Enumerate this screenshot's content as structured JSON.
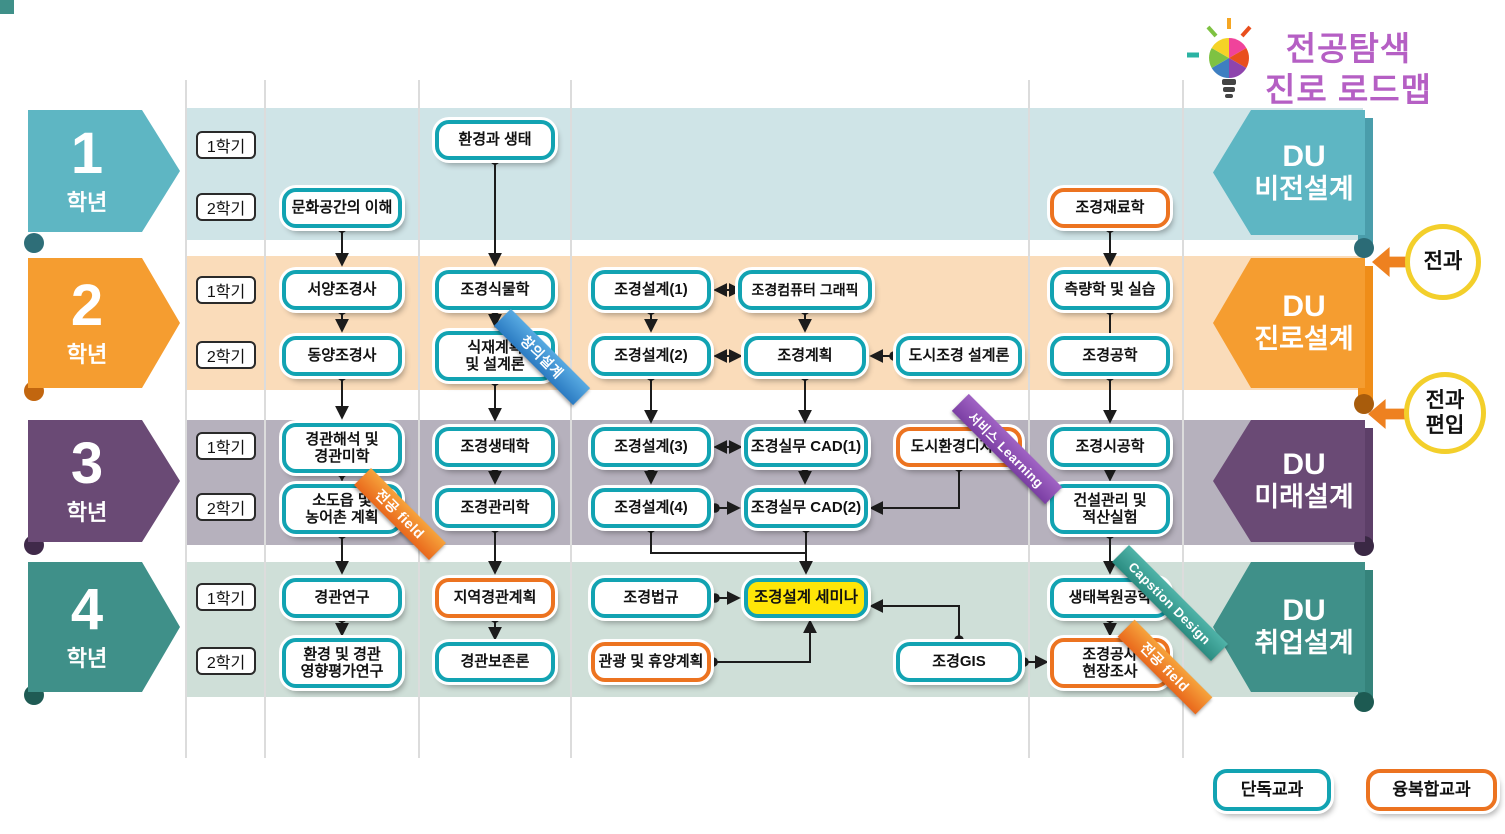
{
  "title": {
    "line1": "전공탐색",
    "line2": "진로 로드맵"
  },
  "years": [
    {
      "num": "1",
      "label": "학년",
      "sem1": "1학기",
      "sem2": "2학기",
      "du_line1": "DU",
      "du_line2": "비전설계",
      "color": "#5eb6c3",
      "band_color": "#cfe4e7"
    },
    {
      "num": "2",
      "label": "학년",
      "sem1": "1학기",
      "sem2": "2학기",
      "du_line1": "DU",
      "du_line2": "진로설계",
      "color": "#f59d30",
      "band_color": "#fadcba"
    },
    {
      "num": "3",
      "label": "학년",
      "sem1": "1학기",
      "sem2": "2학기",
      "du_line1": "DU",
      "du_line2": "미래설계",
      "color": "#6a4a75",
      "band_color": "#b6b1bd"
    },
    {
      "num": "4",
      "label": "학년",
      "sem1": "1학기",
      "sem2": "2학기",
      "du_line1": "DU",
      "du_line2": "취업설계",
      "color": "#3f9089",
      "band_color": "#cfdfd8"
    }
  ],
  "callouts": [
    {
      "label": "전과"
    },
    {
      "label": "전과\n편입"
    }
  ],
  "legend": [
    {
      "label": "단독교과",
      "border_color": "#12a3b2"
    },
    {
      "label": "융복합교과",
      "border_color": "#ec7320"
    }
  ],
  "ribbons": [
    {
      "label": "창의설계",
      "color": "#2b7bc2",
      "attached_to": "식재계획 및 설계론"
    },
    {
      "label": "전공 field",
      "color": "#e9681c",
      "attached_to": "소도읍 및 농어촌 계획"
    },
    {
      "label": "서비스 Learning",
      "color": "#7b3fa3",
      "attached_to": "도시환경디자인"
    },
    {
      "label": "Capstion Design",
      "color": "#2b8c81",
      "attached_to": "생태복원공학"
    },
    {
      "label": "전공 field",
      "color": "#e9681c",
      "attached_to": "조경공사 현장조사"
    }
  ],
  "courses": [
    {
      "label": "환경과 생태",
      "type": "단독교과",
      "year": 1,
      "semester": "1학기"
    },
    {
      "label": "문화공간의 이해",
      "type": "단독교과",
      "year": 1,
      "semester": "2학기"
    },
    {
      "label": "조경재료학",
      "type": "융복합교과",
      "year": 1,
      "semester": "2학기"
    },
    {
      "label": "서양조경사",
      "type": "단독교과",
      "year": 2,
      "semester": "1학기"
    },
    {
      "label": "조경식물학",
      "type": "단독교과",
      "year": 2,
      "semester": "1학기"
    },
    {
      "label": "조경설계(1)",
      "type": "단독교과",
      "year": 2,
      "semester": "1학기"
    },
    {
      "label": "조경컴퓨터 그래픽",
      "type": "단독교과",
      "year": 2,
      "semester": "1학기"
    },
    {
      "label": "측량학 및 실습",
      "type": "단독교과",
      "year": 2,
      "semester": "1학기"
    },
    {
      "label": "동양조경사",
      "type": "단독교과",
      "year": 2,
      "semester": "2학기"
    },
    {
      "label": "식재계획\n및 설계론",
      "type": "단독교과",
      "year": 2,
      "semester": "2학기"
    },
    {
      "label": "조경설계(2)",
      "type": "단독교과",
      "year": 2,
      "semester": "2학기"
    },
    {
      "label": "조경계획",
      "type": "단독교과",
      "year": 2,
      "semester": "2학기"
    },
    {
      "label": "도시조경 설계론",
      "type": "단독교과",
      "year": 2,
      "semester": "2학기"
    },
    {
      "label": "조경공학",
      "type": "단독교과",
      "year": 2,
      "semester": "2학기"
    },
    {
      "label": "경관해석 및\n경관미학",
      "type": "단독교과",
      "year": 3,
      "semester": "1학기"
    },
    {
      "label": "조경생태학",
      "type": "단독교과",
      "year": 3,
      "semester": "1학기"
    },
    {
      "label": "조경설계(3)",
      "type": "단독교과",
      "year": 3,
      "semester": "1학기"
    },
    {
      "label": "조경실무 CAD(1)",
      "type": "단독교과",
      "year": 3,
      "semester": "1학기"
    },
    {
      "label": "도시환경디자인",
      "type": "융복합교과",
      "year": 3,
      "semester": "1학기"
    },
    {
      "label": "조경시공학",
      "type": "단독교과",
      "year": 3,
      "semester": "1학기"
    },
    {
      "label": "소도읍 및\n농어촌 계획",
      "type": "단독교과",
      "year": 3,
      "semester": "2학기"
    },
    {
      "label": "조경관리학",
      "type": "단독교과",
      "year": 3,
      "semester": "2학기"
    },
    {
      "label": "조경설계(4)",
      "type": "단독교과",
      "year": 3,
      "semester": "2학기"
    },
    {
      "label": "조경실무 CAD(2)",
      "type": "단독교과",
      "year": 3,
      "semester": "2학기"
    },
    {
      "label": "건설관리 및\n적산실험",
      "type": "단독교과",
      "year": 3,
      "semester": "2학기"
    },
    {
      "label": "경관연구",
      "type": "단독교과",
      "year": 4,
      "semester": "1학기"
    },
    {
      "label": "지역경관계획",
      "type": "융복합교과",
      "year": 4,
      "semester": "1학기"
    },
    {
      "label": "조경법규",
      "type": "단독교과",
      "year": 4,
      "semester": "1학기"
    },
    {
      "label": "조경설계 세미나",
      "type": "단독교과",
      "highlight": "yellow",
      "year": 4,
      "semester": "1학기"
    },
    {
      "label": "생태복원공학",
      "type": "단독교과",
      "year": 4,
      "semester": "1학기"
    },
    {
      "label": "환경 및 경관\n영향평가연구",
      "type": "단독교과",
      "year": 4,
      "semester": "2학기"
    },
    {
      "label": "경관보존론",
      "type": "단독교과",
      "year": 4,
      "semester": "2학기"
    },
    {
      "label": "관광 및 휴양계획",
      "type": "융복합교과",
      "year": 4,
      "semester": "2학기"
    },
    {
      "label": "조경GIS",
      "type": "단독교과",
      "year": 4,
      "semester": "2학기"
    },
    {
      "label": "조경공사\n현장조사",
      "type": "융복합교과",
      "year": 4,
      "semester": "2학기"
    }
  ],
  "connections": [
    {
      "from": "환경과 생태",
      "to": "조경식물학",
      "style": "arrow"
    },
    {
      "from": "문화공간의 이해",
      "to": "서양조경사",
      "style": "arrow"
    },
    {
      "from": "조경재료학",
      "to": "측량학 및 실습",
      "style": "arrow"
    },
    {
      "from": "서양조경사",
      "to": "동양조경사",
      "style": "arrow"
    },
    {
      "from": "조경식물학",
      "to": "식재계획 및 설계론",
      "style": "arrow"
    },
    {
      "from": "조경설계(1)",
      "to": "조경설계(2)",
      "style": "arrow"
    },
    {
      "from": "조경컴퓨터 그래픽",
      "to": "조경계획",
      "style": "arrow"
    },
    {
      "from": "조경설계(1)",
      "to": "조경컴퓨터 그래픽",
      "style": "double"
    },
    {
      "from": "조경설계(2)",
      "to": "조경계획",
      "style": "double"
    },
    {
      "from": "도시조경 설계론",
      "to": "조경계획",
      "style": "arrow"
    },
    {
      "from": "측량학 및 실습",
      "to": "조경공학",
      "style": "line"
    },
    {
      "from": "동양조경사",
      "to": "경관해석 및 경관미학",
      "style": "arrow"
    },
    {
      "from": "식재계획 및 설계론",
      "to": "조경생태학",
      "style": "arrow"
    },
    {
      "from": "조경설계(2)",
      "to": "조경설계(3)",
      "style": "arrow"
    },
    {
      "from": "조경계획",
      "to": "조경실무 CAD(1)",
      "style": "arrow"
    },
    {
      "from": "조경공학",
      "to": "조경시공학",
      "style": "arrow"
    },
    {
      "from": "조경설계(3)",
      "to": "조경실무 CAD(1)",
      "style": "double"
    },
    {
      "from": "경관해석 및 경관미학",
      "to": "소도읍 및 농어촌 계획",
      "style": "arrow"
    },
    {
      "from": "조경생태학",
      "to": "조경관리학",
      "style": "arrow"
    },
    {
      "from": "조경설계(3)",
      "to": "조경설계(4)",
      "style": "arrow"
    },
    {
      "from": "조경실무 CAD(1)",
      "to": "조경실무 CAD(2)",
      "style": "arrow"
    },
    {
      "from": "조경설계(4)",
      "to": "조경실무 CAD(2)",
      "style": "arrow"
    },
    {
      "from": "도시환경디자인",
      "to": "조경실무 CAD(2)",
      "style": "arrow"
    },
    {
      "from": "조경시공학",
      "to": "건설관리 및 적산실험",
      "style": "arrow"
    },
    {
      "from": "소도읍 및 농어촌 계획",
      "to": "경관연구",
      "style": "arrow"
    },
    {
      "from": "조경관리학",
      "to": "지역경관계획",
      "style": "arrow"
    },
    {
      "from": "조경설계(4)",
      "to": "조경설계 세미나",
      "style": "arrow"
    },
    {
      "from": "조경실무 CAD(2)",
      "to": "조경설계 세미나",
      "style": "arrow"
    },
    {
      "from": "건설관리 및 적산실험",
      "to": "생태복원공학",
      "style": "arrow"
    },
    {
      "from": "경관연구",
      "to": "환경 및 경관 영향평가연구",
      "style": "arrow"
    },
    {
      "from": "지역경관계획",
      "to": "경관보존론",
      "style": "arrow"
    },
    {
      "from": "조경법규",
      "to": "조경설계 세미나",
      "style": "arrow"
    },
    {
      "from": "관광 및 휴양계획",
      "to": "조경설계 세미나",
      "style": "arrow"
    },
    {
      "from": "조경GIS",
      "to": "조경설계 세미나",
      "style": "arrow"
    },
    {
      "from": "조경GIS",
      "to": "조경공사 현장조사",
      "style": "arrow"
    },
    {
      "from": "생태복원공학",
      "to": "조경공사 현장조사",
      "style": "arrow"
    }
  ],
  "colors": {
    "single_border": "#12a3b2",
    "fusion_border": "#ec7320",
    "seminar_bg": "#ffe608",
    "title_text": "#b55fc4",
    "callout_ring": "#f3cf2b",
    "callout_arrow": "#ee8120"
  }
}
